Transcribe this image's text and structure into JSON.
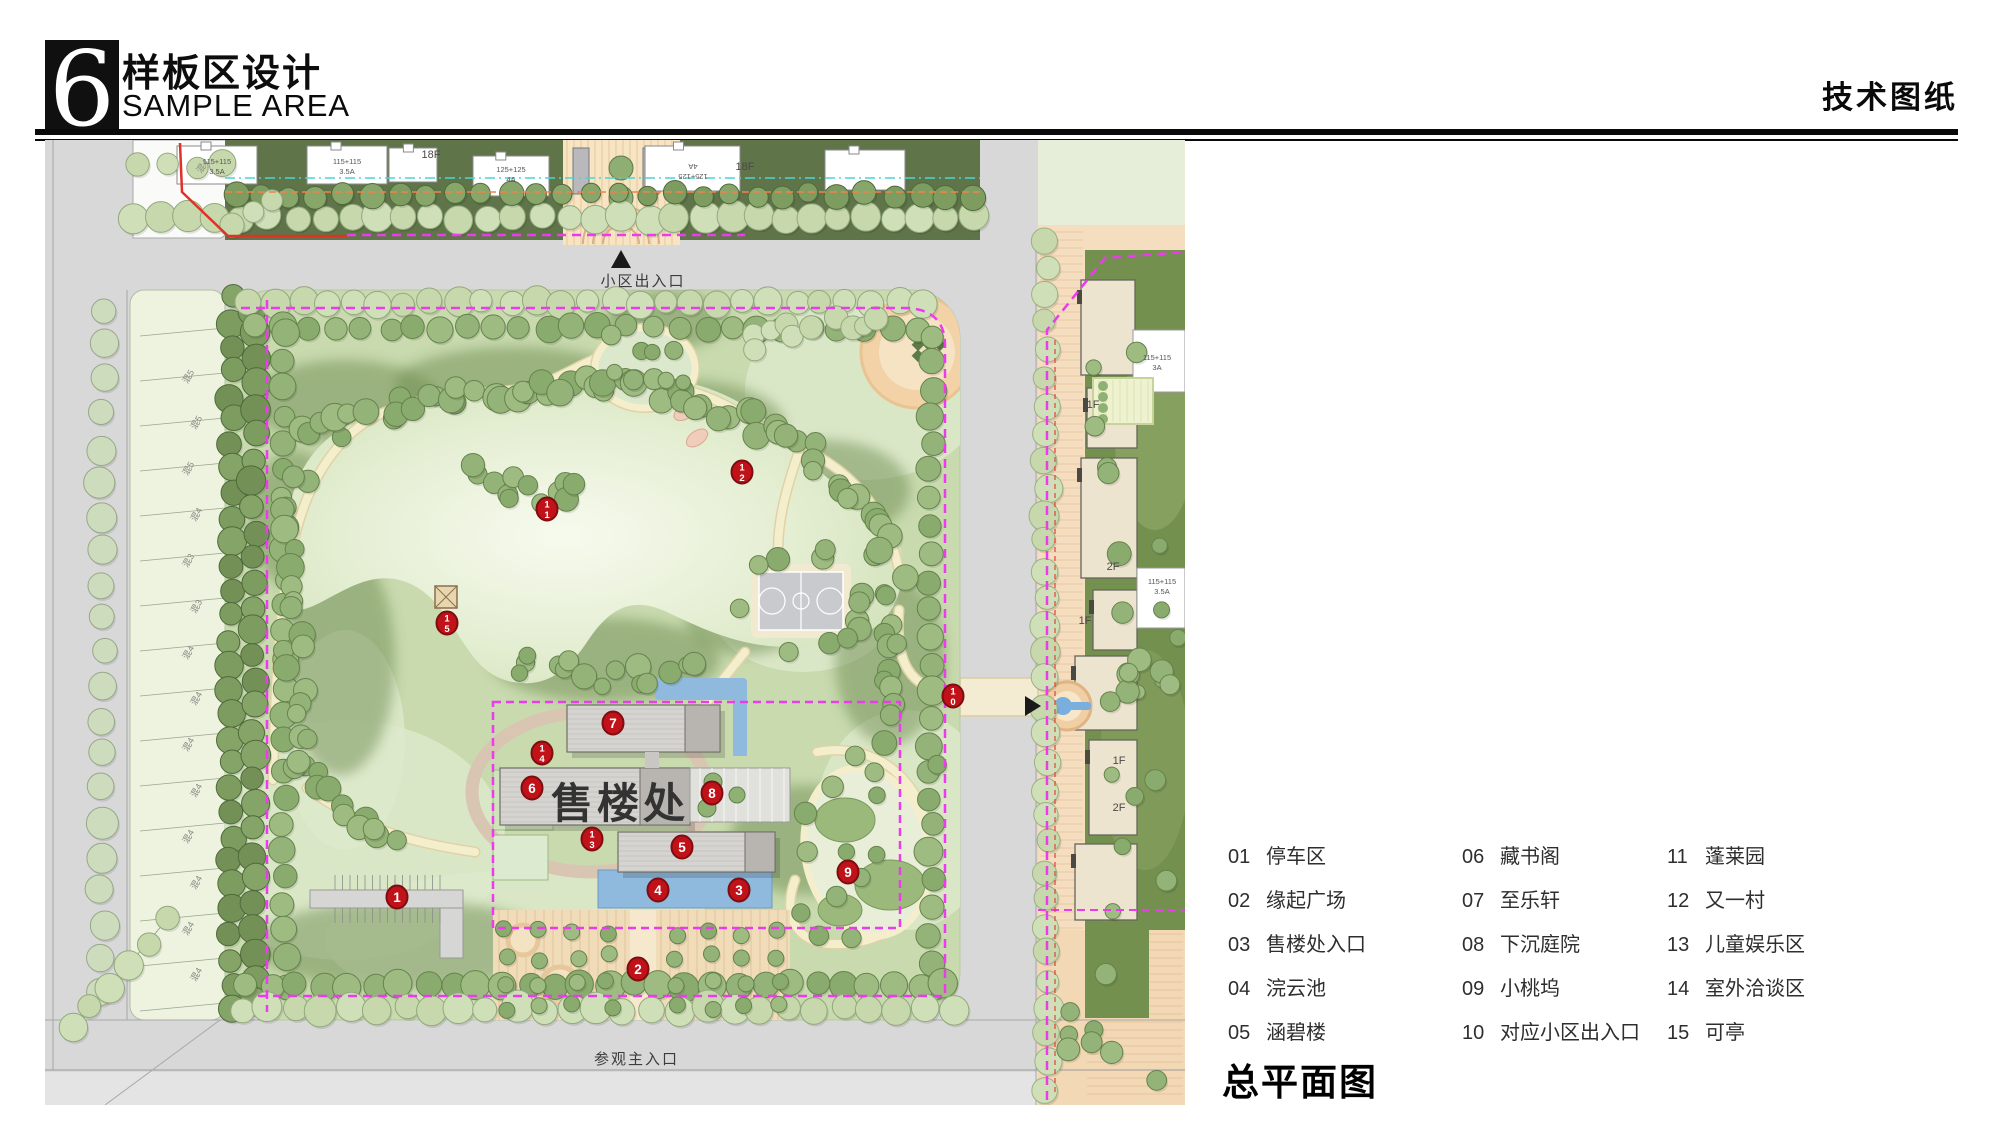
{
  "header": {
    "logo_glyph": "6",
    "title_cn": "样板区设计",
    "title_en": "SAMPLE AREA",
    "doc_label": "技术图纸"
  },
  "plan_title": "总平面图",
  "legend": {
    "items": [
      {
        "num": "01",
        "name": "停车区"
      },
      {
        "num": "02",
        "name": "缘起广场"
      },
      {
        "num": "03",
        "name": "售楼处入口"
      },
      {
        "num": "04",
        "name": "浣云池"
      },
      {
        "num": "05",
        "name": "涵碧楼"
      },
      {
        "num": "06",
        "name": "藏书阁"
      },
      {
        "num": "07",
        "name": "至乐轩"
      },
      {
        "num": "08",
        "name": "下沉庭院"
      },
      {
        "num": "09",
        "name": "小桃坞"
      },
      {
        "num": "10",
        "name": "对应小区出入口"
      },
      {
        "num": "11",
        "name": "蓬莱园"
      },
      {
        "num": "12",
        "name": "又一村"
      },
      {
        "num": "13",
        "name": "儿童娱乐区"
      },
      {
        "num": "14",
        "name": "室外洽谈区"
      },
      {
        "num": "15",
        "name": "可亭"
      }
    ]
  },
  "map": {
    "sales_office": {
      "t": "售楼处",
      "x": 575,
      "y": 678,
      "s": 42
    },
    "road_labels": [
      {
        "t": "小区出入口",
        "x": 598,
        "y": 146,
        "s": 15,
        "anchor": "middle"
      },
      {
        "t": "参观主入口",
        "x": 549,
        "y": 924,
        "s": 15,
        "anchor": "start"
      }
    ],
    "floor_labels": [
      {
        "t": "1F",
        "x": 1048,
        "y": 268
      },
      {
        "t": "2F",
        "x": 1068,
        "y": 430
      },
      {
        "t": "1F",
        "x": 1040,
        "y": 484
      },
      {
        "t": "1F",
        "x": 1074,
        "y": 624
      },
      {
        "t": "2F",
        "x": 1074,
        "y": 671
      },
      {
        "t": "18F",
        "x": 386,
        "y": 18
      },
      {
        "t": "18F",
        "x": 700,
        "y": 30
      }
    ],
    "tower_labels": [
      {
        "lines": [
          "115+115",
          "3.5A"
        ],
        "x": 172,
        "y": 24
      },
      {
        "lines": [
          "115+115",
          "3.5A"
        ],
        "x": 302,
        "y": 24
      },
      {
        "lines": [
          "125+125",
          "4A"
        ],
        "x": 466,
        "y": 32
      },
      {
        "lines": [
          "125+125",
          "4A"
        ],
        "x": 648,
        "y": 24,
        "rot": 180
      },
      {
        "lines": [
          "115+115",
          "3A"
        ],
        "x": 1112,
        "y": 220
      },
      {
        "lines": [
          "115+115",
          "3.5A"
        ],
        "x": 1117,
        "y": 444
      }
    ],
    "lot_labels": [
      "混5",
      "混5",
      "混5",
      "混4",
      "混3",
      "混3",
      "混4",
      "混4",
      "混4",
      "混4",
      "混4",
      "混4",
      "混4",
      "混4"
    ],
    "corner_lot_label": "混4",
    "markers": [
      {
        "n": "1",
        "x": 352,
        "y": 757
      },
      {
        "n": "2",
        "x": 593,
        "y": 829
      },
      {
        "n": "3",
        "x": 694,
        "y": 750
      },
      {
        "n": "4",
        "x": 613,
        "y": 750
      },
      {
        "n": "5",
        "x": 637,
        "y": 707
      },
      {
        "n": "6",
        "x": 487,
        "y": 648
      },
      {
        "n": "7",
        "x": 568,
        "y": 583
      },
      {
        "n": "8",
        "x": 667,
        "y": 653
      },
      {
        "n": "9",
        "x": 803,
        "y": 732
      },
      {
        "n": "10",
        "x": 908,
        "y": 556
      },
      {
        "n": "11",
        "x": 502,
        "y": 369
      },
      {
        "n": "12",
        "x": 697,
        "y": 332
      },
      {
        "n": "13",
        "x": 547,
        "y": 699
      },
      {
        "n": "14",
        "x": 497,
        "y": 613
      },
      {
        "n": "15",
        "x": 402,
        "y": 483
      }
    ]
  },
  "colors": {
    "marker_red": "#c01218",
    "marker_edge": "#7d0d10",
    "boundary_magenta": "#ea3cea",
    "boundary_red": "#e03028",
    "line_cyan": "#49d6d6",
    "line_orange": "#ef8448",
    "water_blue": "#8fb9dd",
    "path_cream": "#f4eecd",
    "park_green": "#c8daae",
    "road_gray": "#d8d8d8",
    "plaza_orange": "#f1dcba"
  }
}
